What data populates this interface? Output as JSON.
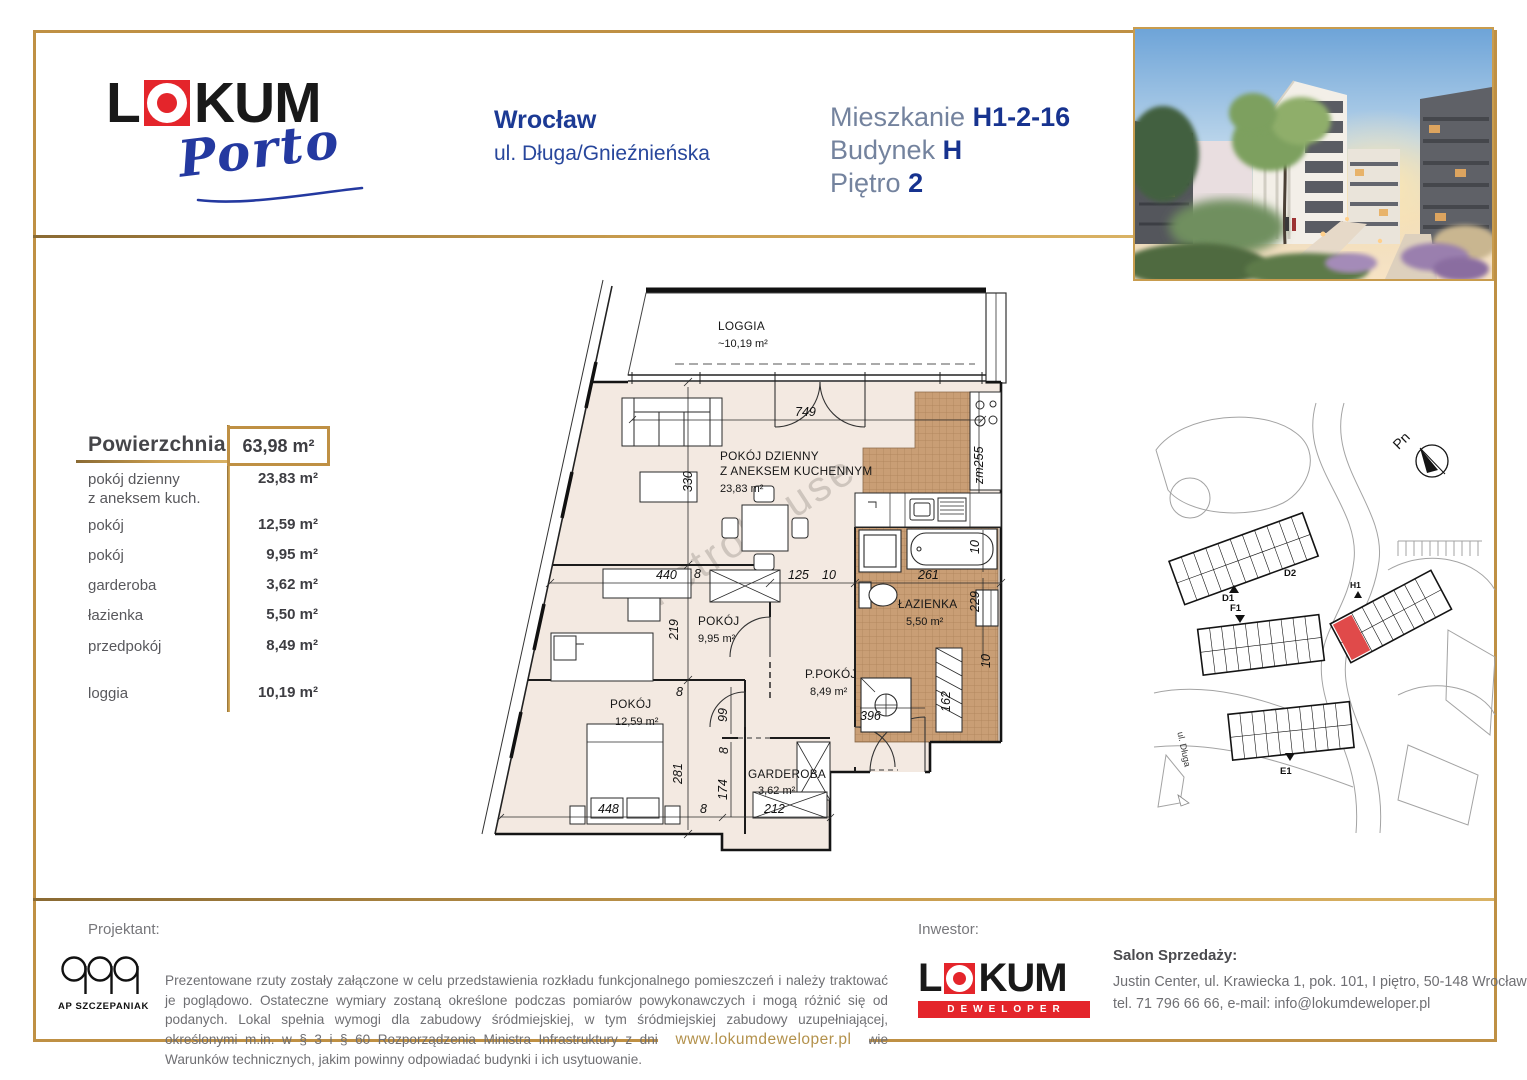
{
  "header": {
    "brand_l": "L",
    "brand_rest": "KUM",
    "brand_sub": "Porto",
    "city": "Wrocław",
    "street": "ul. Długa/Gnieźnieńska",
    "apt": {
      "l1": "Mieszkanie",
      "v1": "H1-2-16",
      "l2": "Budynek",
      "v2": "H",
      "l3": "Piętro",
      "v3": "2"
    }
  },
  "area_table": {
    "title": "Powierzchnia",
    "total": "63,98 m²",
    "rows": [
      {
        "label": "pokój dzienny",
        "label2": "z aneksem kuch.",
        "value": "23,83 m²"
      },
      {
        "label": "pokój",
        "label2": "",
        "value": "12,59 m²"
      },
      {
        "label": "pokój",
        "label2": "",
        "value": "9,95 m²"
      },
      {
        "label": "garderoba",
        "label2": "",
        "value": "3,62 m²"
      },
      {
        "label": "łazienka",
        "label2": "",
        "value": "5,50 m²"
      },
      {
        "label": "przedpokój",
        "label2": "",
        "value": "8,49 m²"
      },
      {
        "label": "loggia",
        "label2": "",
        "value": "10,19 m²"
      }
    ]
  },
  "floor_plan": {
    "watermark": "metrohouse",
    "rooms": {
      "loggia": {
        "name": "LOGGIA",
        "area": "~10,19 m²"
      },
      "living": {
        "name": "POKÓJ DZIENNY",
        "name2": "Z ANEKSEM KUCHENNYM",
        "area": "23,83 m²"
      },
      "pokoj1": {
        "name": "POKÓJ",
        "area": "9,95 m²"
      },
      "pokoj2": {
        "name": "POKÓJ",
        "area": "12,59 m²"
      },
      "ppokoj": {
        "name": "P.POKÓJ",
        "area": "8,49 m²"
      },
      "lazienka": {
        "name": "ŁAZIENKA",
        "area": "5,50 m²"
      },
      "garderoba": {
        "name": "GARDEROBA",
        "area": "3,62 m²"
      }
    },
    "dims": {
      "w749": "749",
      "h330": "330",
      "w440": "440",
      "g8a": "8",
      "w125": "125",
      "g10a": "10",
      "w261": "261",
      "zm255": "zm255",
      "h219": "219",
      "d99": "99",
      "g8b": "8",
      "h281": "281",
      "w448": "448",
      "g8c": "8",
      "w212": "212",
      "h174": "174",
      "g8d": "8",
      "w396": "396",
      "h162": "162",
      "g10b": "10",
      "g10c": "10",
      "h229": "229"
    }
  },
  "site_plan": {
    "north": "Pn",
    "street": "ul. Długa",
    "b_d1": "D1",
    "b_d2": "D2",
    "b_f1": "F1",
    "b_e1": "E1",
    "b_h1": "H1"
  },
  "footer": {
    "projektant_label": "Projektant:",
    "projektant_name": "AP SZCZEPANIAK",
    "disclaimer": "Prezentowane rzuty zostały załączone w celu przedstawienia rozkładu funkcjonalnego pomieszczeń i należy traktować je poglądowo. Ostateczne wymiary zostaną określone podczas pomiarów powykonawczych i mogą różnić się od podanych. Lokal spełnia wymogi dla zabudowy śródmiejskiej, w tym śródmiejskiej zabudowy uzupełniającej, określonymi m.in. w § 3 i § 60 Rozporządzenia Ministra Infrastruktury z dnia 12 kwietnia 2002 roku w sprawie Warunków technicznych, jakim powinny odpowiadać budynki i ich usytuowanie.",
    "inwestor_label": "Inwestor:",
    "inwestor_brand_l": "L",
    "inwestor_brand_rest": "KUM",
    "inwestor_brand_sub": "DEWELOPER",
    "sales_title": "Salon Sprzedaży:",
    "sales_address": "Justin Center, ul. Krawiecka 1, pok. 101, I piętro, 50-148 Wrocław",
    "sales_contact": "tel. 71 796 66 66, e-mail: info@lokumdeweloper.pl",
    "website": "www.lokumdeweloper.pl"
  },
  "colors": {
    "gold": "#bf9044",
    "brand_blue": "#17338f",
    "label_blue": "#74839e",
    "brand_red": "#e4252b",
    "floor_beige": "#f3e9e1",
    "tile_brown": "#c99e75"
  }
}
